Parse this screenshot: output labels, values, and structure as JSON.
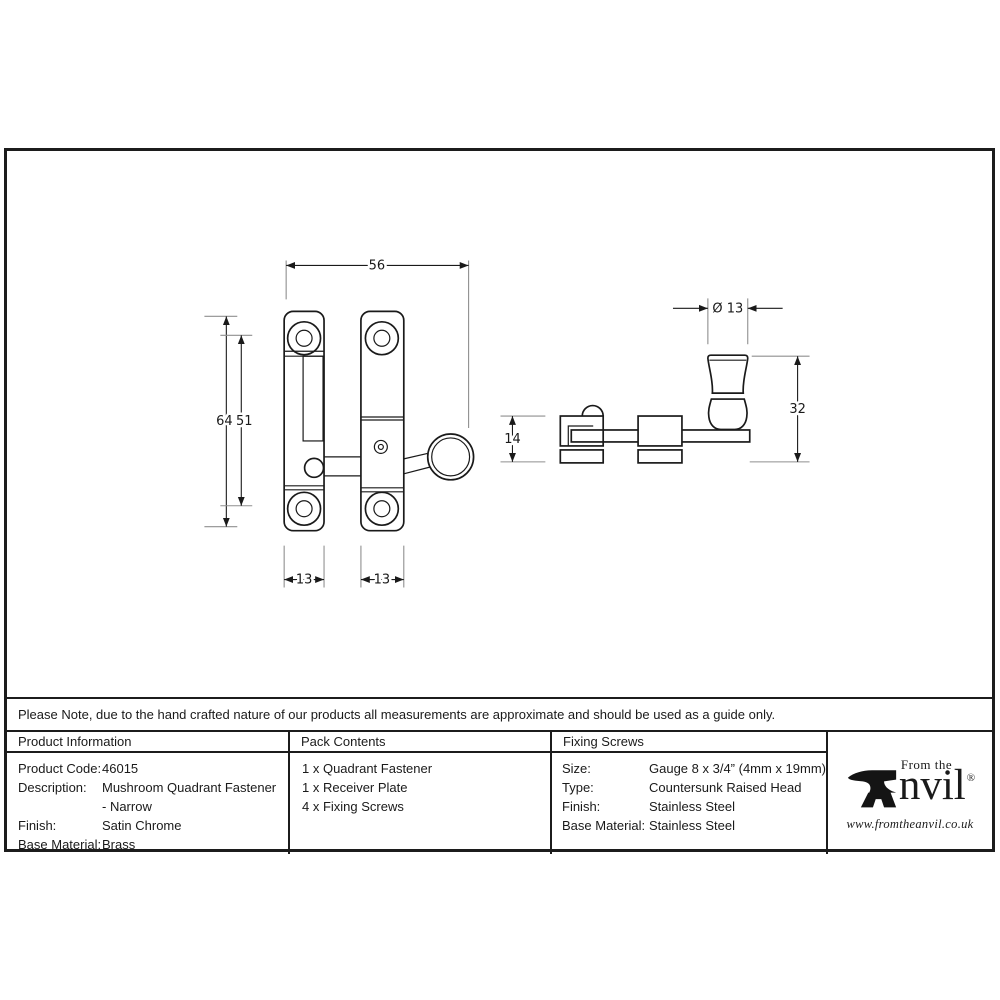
{
  "note": "Please Note, due to the hand crafted nature of our products all measurements are approximate and should be used as a guide only.",
  "drawing": {
    "front": {
      "overall_width": "56",
      "overall_height": "64",
      "hole_centres": "51",
      "left_plate_width": "13",
      "right_plate_width": "13"
    },
    "side": {
      "knob_diameter": "Ø 13",
      "bracket_height": "14",
      "knob_overall_height": "32"
    }
  },
  "table": {
    "product_information": {
      "header": "Product Information",
      "rows": [
        [
          "Product Code:",
          "46015"
        ],
        [
          "Description:",
          "Mushroom Quadrant Fastener"
        ],
        [
          "",
          "- Narrow"
        ],
        [
          "Finish:",
          "Satin Chrome"
        ],
        [
          "Base Material:",
          "Brass"
        ]
      ]
    },
    "pack_contents": {
      "header": "Pack Contents",
      "items": [
        "1 x Quadrant Fastener",
        "1 x Receiver Plate",
        "4 x Fixing Screws"
      ]
    },
    "fixing_screws": {
      "header": "Fixing Screws",
      "rows": [
        [
          "Size:",
          "Gauge 8 x 3/4” (4mm x 19mm)"
        ],
        [
          "Type:",
          "Countersunk Raised Head"
        ],
        [
          "Finish:",
          "Stainless Steel"
        ],
        [
          "Base Material:",
          "Stainless Steel"
        ]
      ]
    },
    "logo": {
      "tagline": "From the",
      "name_rest": "nvil",
      "registered": "®",
      "url": "www.fromtheanvil.co.uk"
    }
  }
}
